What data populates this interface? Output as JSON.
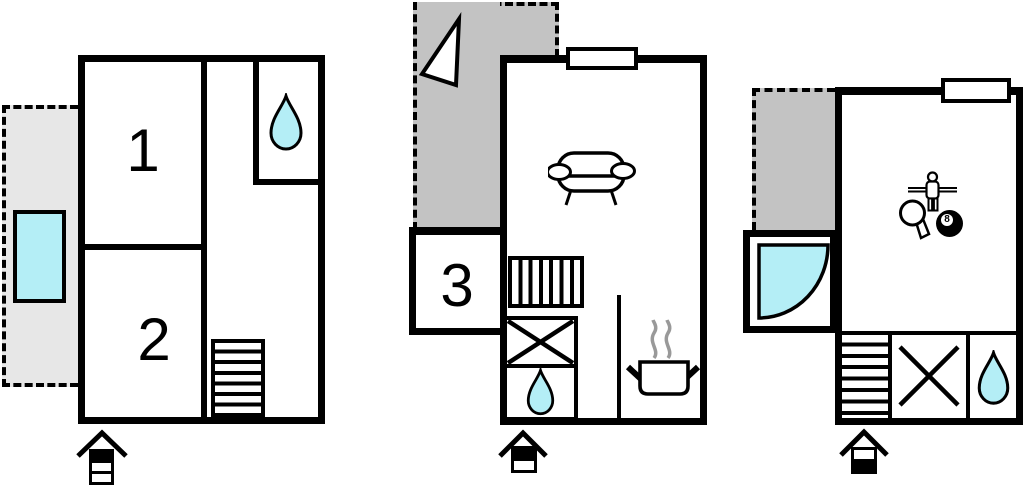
{
  "colors": {
    "line": "#000000",
    "water": "#b4eef6",
    "terrace-light": "#e7e7e7",
    "terrace-dark": "#c3c3c3",
    "steam": "#999999",
    "background": "#ffffff"
  },
  "floors": [
    {
      "name": "floor-left",
      "rooms": [
        {
          "label": "1"
        },
        {
          "label": "2"
        }
      ],
      "features": [
        "terrace",
        "pool",
        "bathroom-sink",
        "stairs",
        "entrance"
      ]
    },
    {
      "name": "floor-middle",
      "rooms": [
        {
          "label": "3"
        }
      ],
      "features": [
        "terrace",
        "north-arrow",
        "window",
        "sofa",
        "stairs",
        "shower",
        "sink",
        "kitchen-stove",
        "entrance"
      ]
    },
    {
      "name": "floor-right",
      "rooms": [],
      "billiard_ball": {
        "label": "8"
      },
      "features": [
        "terrace",
        "window",
        "foosball",
        "table-tennis",
        "billiards",
        "corner-shower",
        "stairs",
        "shower",
        "sink",
        "entrance"
      ]
    }
  ],
  "icons": {
    "water_drop": "teardrop-shape",
    "pool": "cyan-rectangle",
    "corner_shower": "quarter-circle",
    "shower": "crossed-square",
    "stairs": "hatched-rectangle",
    "sofa": "sofa-outline",
    "stove_pot": "pot-with-steam",
    "north_arrow": "white-triangle",
    "foosball": "rod-player-figure",
    "table_tennis": "paddle",
    "billiards": "eight-ball",
    "entrance": "roof-arrow-with-striped-post",
    "window": "white-bar-on-wall",
    "terrace": "dashed-gray-area"
  }
}
